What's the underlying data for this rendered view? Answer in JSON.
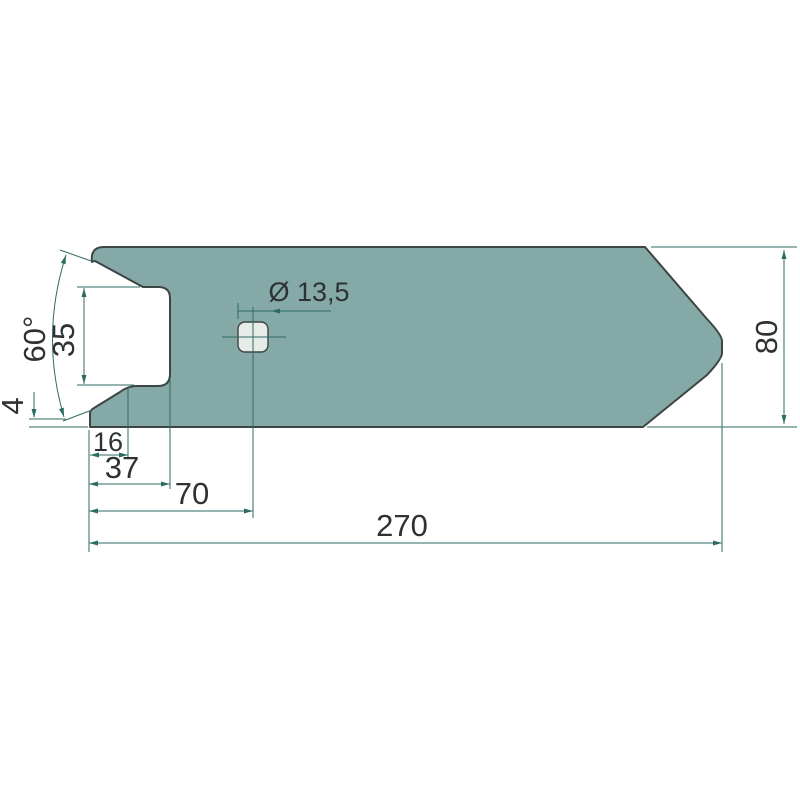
{
  "drawing": {
    "title": "Pointed share blade – dimensioned technical drawing",
    "view": "top view, single part, white background",
    "colors": {
      "part_fill": "#85a9a7",
      "part_outline": "#3d4543",
      "dimension_lines": "#2e6b63",
      "hole_fill": "#e8ece9",
      "text": "#2e3234",
      "background": "#ffffff"
    },
    "labels": {
      "overall_length": "270",
      "overall_width": "80",
      "hole_center_offset": "70",
      "slot_depth": "37",
      "chamfer_foot": "16",
      "edge_step": "4",
      "slot_height": "35",
      "opening_angle": "60°",
      "hole_diameter": "Ø 13,5"
    }
  }
}
